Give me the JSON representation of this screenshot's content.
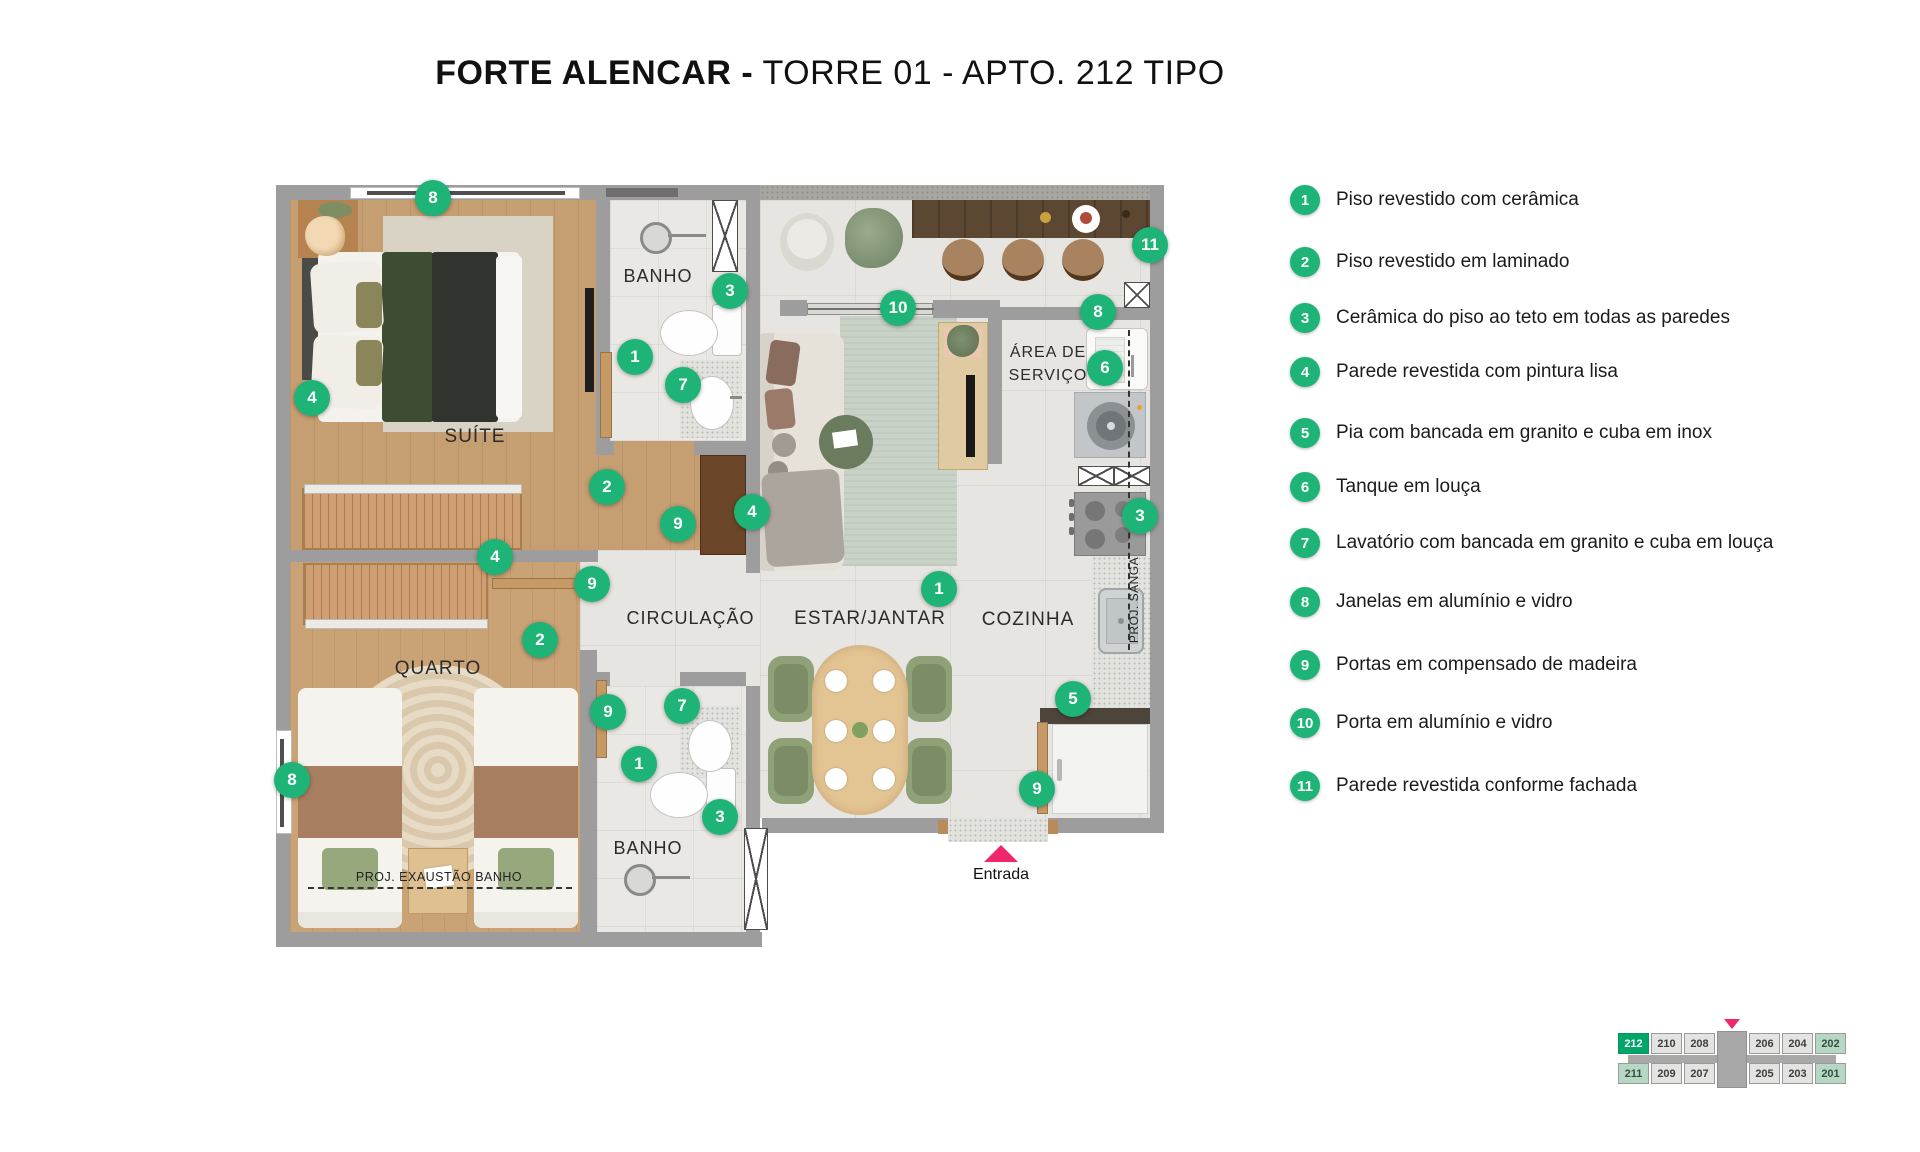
{
  "title": {
    "project": "FORTE ALENCAR -",
    "rest": " TORRE 01 - APTO. 212 TIPO"
  },
  "legend": {
    "items": [
      {
        "num": "1",
        "label": "Piso revestido com cerâmica"
      },
      {
        "num": "2",
        "label": "Piso revestido em laminado"
      },
      {
        "num": "3",
        "label": "Cerâmica do piso ao teto em todas as paredes"
      },
      {
        "num": "4",
        "label": "Parede revestida com pintura lisa"
      },
      {
        "num": "5",
        "label": "Pia com bancada em granito e cuba em inox"
      },
      {
        "num": "6",
        "label": "Tanque em louça"
      },
      {
        "num": "7",
        "label": "Lavatório com bancada em granito e cuba em louça"
      },
      {
        "num": "8",
        "label": "Janelas em alumínio e vidro"
      },
      {
        "num": "9",
        "label": "Portas em compensado de madeira"
      },
      {
        "num": "10",
        "label": "Porta em alumínio e vidro"
      },
      {
        "num": "11",
        "label": "Parede revestida conforme fachada"
      }
    ]
  },
  "plan": {
    "labels": {
      "suite": "SUÍTE",
      "banho1": "BANHO",
      "banho2": "BANHO",
      "quarto": "QUARTO",
      "circulacao": "CIRCULAÇÃO",
      "estar": "ESTAR/JANTAR",
      "cozinha": "COZINHA",
      "area1": "ÁREA DE",
      "area2": "SERVIÇO",
      "proj_exaustao": "PROJ. EXAUSTÃO BANHO",
      "proj_sanga": "PROJ. SANGA",
      "entrada": "Entrada"
    },
    "markers": [
      {
        "n": "8",
        "x": 433,
        "y": 198
      },
      {
        "n": "4",
        "x": 312,
        "y": 398
      },
      {
        "n": "1",
        "x": 635,
        "y": 357
      },
      {
        "n": "7",
        "x": 683,
        "y": 385
      },
      {
        "n": "3",
        "x": 730,
        "y": 291
      },
      {
        "n": "2",
        "x": 607,
        "y": 487
      },
      {
        "n": "9",
        "x": 678,
        "y": 524
      },
      {
        "n": "4",
        "x": 752,
        "y": 512
      },
      {
        "n": "4",
        "x": 495,
        "y": 557
      },
      {
        "n": "9",
        "x": 592,
        "y": 584
      },
      {
        "n": "2",
        "x": 540,
        "y": 640
      },
      {
        "n": "9",
        "x": 608,
        "y": 712
      },
      {
        "n": "7",
        "x": 682,
        "y": 706
      },
      {
        "n": "1",
        "x": 639,
        "y": 764
      },
      {
        "n": "8",
        "x": 292,
        "y": 780
      },
      {
        "n": "3",
        "x": 720,
        "y": 817
      },
      {
        "n": "10",
        "x": 898,
        "y": 308
      },
      {
        "n": "11",
        "x": 1150,
        "y": 245
      },
      {
        "n": "8",
        "x": 1098,
        "y": 312
      },
      {
        "n": "6",
        "x": 1105,
        "y": 368
      },
      {
        "n": "3",
        "x": 1140,
        "y": 516
      },
      {
        "n": "1",
        "x": 939,
        "y": 589
      },
      {
        "n": "5",
        "x": 1073,
        "y": 699
      },
      {
        "n": "9",
        "x": 1037,
        "y": 789
      }
    ]
  },
  "unit_map": {
    "rows": [
      [
        {
          "num": "212",
          "status": "selected"
        },
        {
          "num": "210",
          "status": "normal"
        },
        {
          "num": "208",
          "status": "normal"
        },
        {
          "num": "206",
          "status": "normal"
        },
        {
          "num": "204",
          "status": "normal"
        },
        {
          "num": "202",
          "status": "light"
        }
      ],
      [
        {
          "num": "211",
          "status": "light"
        },
        {
          "num": "209",
          "status": "normal"
        },
        {
          "num": "207",
          "status": "normal"
        },
        {
          "num": "205",
          "status": "normal"
        },
        {
          "num": "203",
          "status": "normal"
        },
        {
          "num": "201",
          "status": "light"
        }
      ]
    ]
  },
  "colors": {
    "marker_green": "#1eb377",
    "selected_unit_green": "#00a56a",
    "light_unit_green": "#b5d7c4",
    "entry_pink": "#f0276c",
    "wall_gray": "#9d9d9d",
    "wood": "#c59e71",
    "tile": "#e7e5e2"
  }
}
